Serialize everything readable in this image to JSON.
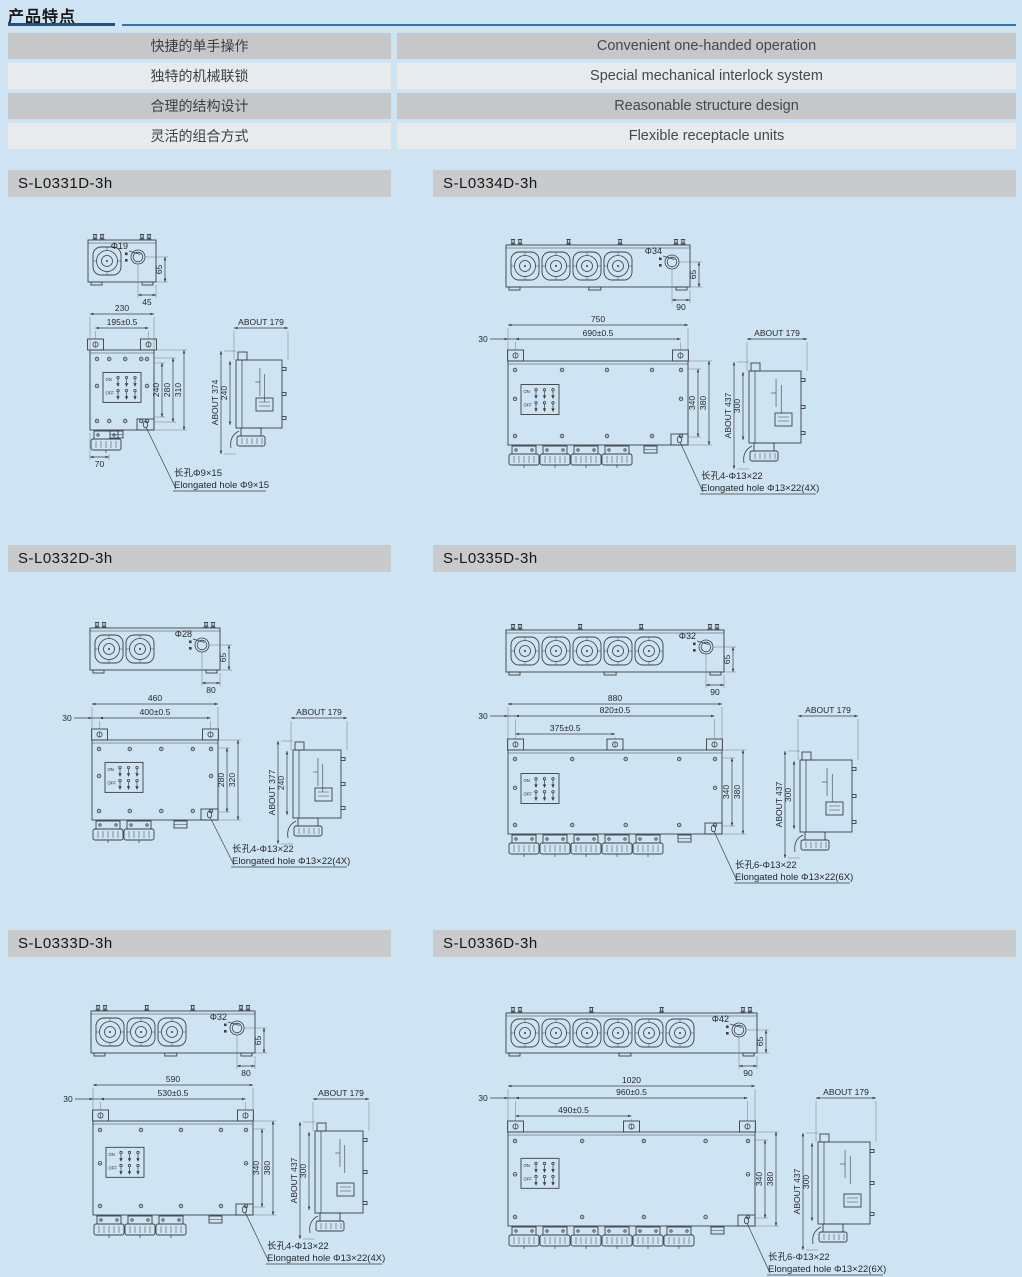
{
  "page": {
    "title": "产品特点"
  },
  "features": {
    "rows": [
      {
        "zh": "快捷的单手操作",
        "en": "Convenient one-handed operation"
      },
      {
        "zh": "独特的机械联锁",
        "en": "Special mechanical interlock system"
      },
      {
        "zh": "合理的结构设计",
        "en": "Reasonable structure design"
      },
      {
        "zh": "灵活的组合方式",
        "en": "Flexible receptacle units"
      }
    ]
  },
  "drawing_labels": {
    "on": "ON",
    "off": "OFF"
  },
  "models": [
    {
      "name": "S-L0331D-3h",
      "sockets": 1,
      "top": {
        "diameter": "Φ19",
        "height": "65",
        "offset": "45"
      },
      "front": {
        "total_width": "230",
        "mount_width": "195±0.5",
        "left_offset": "",
        "mid_width": "",
        "heights": [
          "240",
          "280",
          "310"
        ],
        "foot_width": "70"
      },
      "side": {
        "depth": "ABOUT 179",
        "total_height": "ABOUT 374",
        "body_height": "240"
      },
      "hole_note_zh": "长孔Φ9×15",
      "hole_note_en": "Elongated hole Φ9×15"
    },
    {
      "name": "S-L0334D-3h",
      "sockets": 4,
      "top": {
        "diameter": "Φ34",
        "height": "65",
        "offset": "90"
      },
      "front": {
        "total_width": "750",
        "mount_width": "690±0.5",
        "left_offset": "30",
        "mid_width": "",
        "heights": [
          "340",
          "380"
        ],
        "foot_width": ""
      },
      "side": {
        "depth": "ABOUT 179",
        "total_height": "ABOUT 437",
        "body_height": "300"
      },
      "hole_note_zh": "长孔4-Φ13×22",
      "hole_note_en": "Elongated hole Φ13×22(4X)"
    },
    {
      "name": "S-L0332D-3h",
      "sockets": 2,
      "top": {
        "diameter": "Φ28",
        "height": "65",
        "offset": "80"
      },
      "front": {
        "total_width": "460",
        "mount_width": "400±0.5",
        "left_offset": "30",
        "mid_width": "",
        "heights": [
          "280",
          "320"
        ],
        "foot_width": ""
      },
      "side": {
        "depth": "ABOUT 179",
        "total_height": "ABOUT 377",
        "body_height": "240"
      },
      "hole_note_zh": "长孔4-Φ13×22",
      "hole_note_en": "Elongated hole Φ13×22(4X)"
    },
    {
      "name": "S-L0335D-3h",
      "sockets": 5,
      "top": {
        "diameter": "Φ32",
        "height": "65",
        "offset": "90"
      },
      "front": {
        "total_width": "880",
        "mount_width": "820±0.5",
        "left_offset": "30",
        "mid_width": "375±0.5",
        "heights": [
          "340",
          "380"
        ],
        "foot_width": ""
      },
      "side": {
        "depth": "ABOUT 179",
        "total_height": "ABOUT 437",
        "body_height": "300"
      },
      "hole_note_zh": "长孔6-Φ13×22",
      "hole_note_en": "Elongated hole Φ13×22(6X)"
    },
    {
      "name": "S-L0333D-3h",
      "sockets": 3,
      "top": {
        "diameter": "Φ32",
        "height": "65",
        "offset": "80"
      },
      "front": {
        "total_width": "590",
        "mount_width": "530±0.5",
        "left_offset": "30",
        "mid_width": "",
        "heights": [
          "340",
          "380"
        ],
        "foot_width": ""
      },
      "side": {
        "depth": "ABOUT 179",
        "total_height": "ABOUT 437",
        "body_height": "300"
      },
      "hole_note_zh": "长孔4-Φ13×22",
      "hole_note_en": "Elongated hole Φ13×22(4X)"
    },
    {
      "name": "S-L0336D-3h",
      "sockets": 6,
      "top": {
        "diameter": "Φ42",
        "height": "65",
        "offset": "90"
      },
      "front": {
        "total_width": "1020",
        "mount_width": "960±0.5",
        "left_offset": "30",
        "mid_width": "490±0.5",
        "heights": [
          "340",
          "380"
        ],
        "foot_width": ""
      },
      "side": {
        "depth": "ABOUT 179",
        "total_height": "ABOUT 437",
        "body_height": "300"
      },
      "hole_note_zh": "长孔6-Φ13×22",
      "hole_note_en": "Elongated hole Φ13×22(6X)"
    }
  ]
}
